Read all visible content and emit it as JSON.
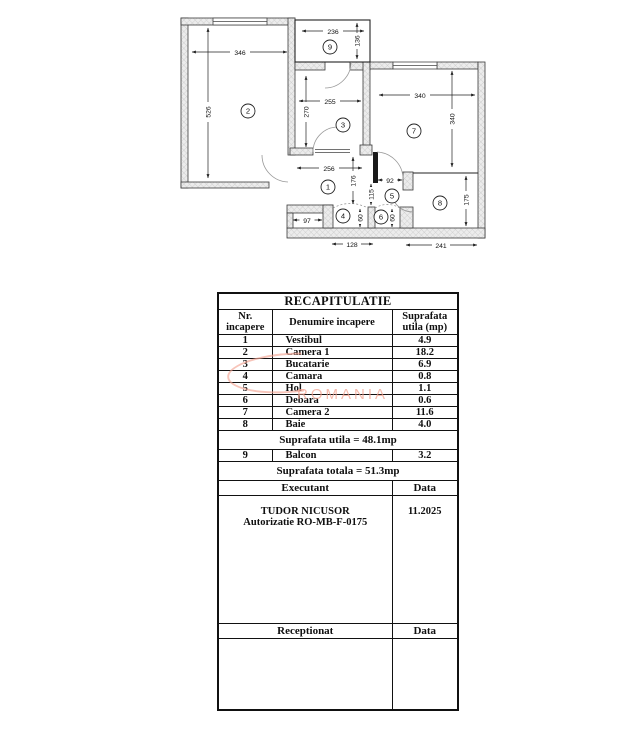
{
  "plan": {
    "rooms": [
      {
        "n": "1"
      },
      {
        "n": "2"
      },
      {
        "n": "3"
      },
      {
        "n": "4"
      },
      {
        "n": "5"
      },
      {
        "n": "6"
      },
      {
        "n": "7"
      },
      {
        "n": "8"
      },
      {
        "n": "9"
      }
    ],
    "dims": [
      {
        "v": "346"
      },
      {
        "v": "526"
      },
      {
        "v": "236"
      },
      {
        "v": "136"
      },
      {
        "v": "255"
      },
      {
        "v": "270"
      },
      {
        "v": "340"
      },
      {
        "v": "340"
      },
      {
        "v": "256"
      },
      {
        "v": "176"
      },
      {
        "v": "97"
      },
      {
        "v": "92"
      },
      {
        "v": "115"
      },
      {
        "v": "60"
      },
      {
        "v": "60"
      },
      {
        "v": "175"
      },
      {
        "v": "128"
      },
      {
        "v": "241"
      }
    ]
  },
  "watermark": {
    "text": "ROMANIA",
    "color": "#f2a593"
  },
  "table": {
    "title": "RECAPITULATIE",
    "headers": {
      "col1": "Nr. incapere",
      "col2": "Denumire incapere",
      "col3": "Suprafata utila (mp)"
    },
    "rows": [
      {
        "nr": "1",
        "name": "Vestibul",
        "area": "4.9"
      },
      {
        "nr": "2",
        "name": "Camera 1",
        "area": "18.2"
      },
      {
        "nr": "3",
        "name": "Bucatarie",
        "area": "6.9"
      },
      {
        "nr": "4",
        "name": "Camara",
        "area": "0.8"
      },
      {
        "nr": "5",
        "name": "Hol",
        "area": "1.1"
      },
      {
        "nr": "6",
        "name": "Debara",
        "area": "0.6"
      },
      {
        "nr": "7",
        "name": "Camera 2",
        "area": "11.6"
      },
      {
        "nr": "8",
        "name": "Baie",
        "area": "4.0"
      }
    ],
    "subtotal": "Suprafata utila = 48.1mp",
    "balcony_row": {
      "nr": "9",
      "name": "Balcon",
      "area": "3.2"
    },
    "total": "Suprafata totala = 51.3mp",
    "executant_label": "Executant",
    "executant_data_label": "Data",
    "executant_name": "TUDOR NICUSOR",
    "executant_auth": "Autorizatie RO-MB-F-0175",
    "executant_date": "11.2025",
    "receptionat_label": "Receptionat",
    "receptionat_data_label": "Data"
  }
}
